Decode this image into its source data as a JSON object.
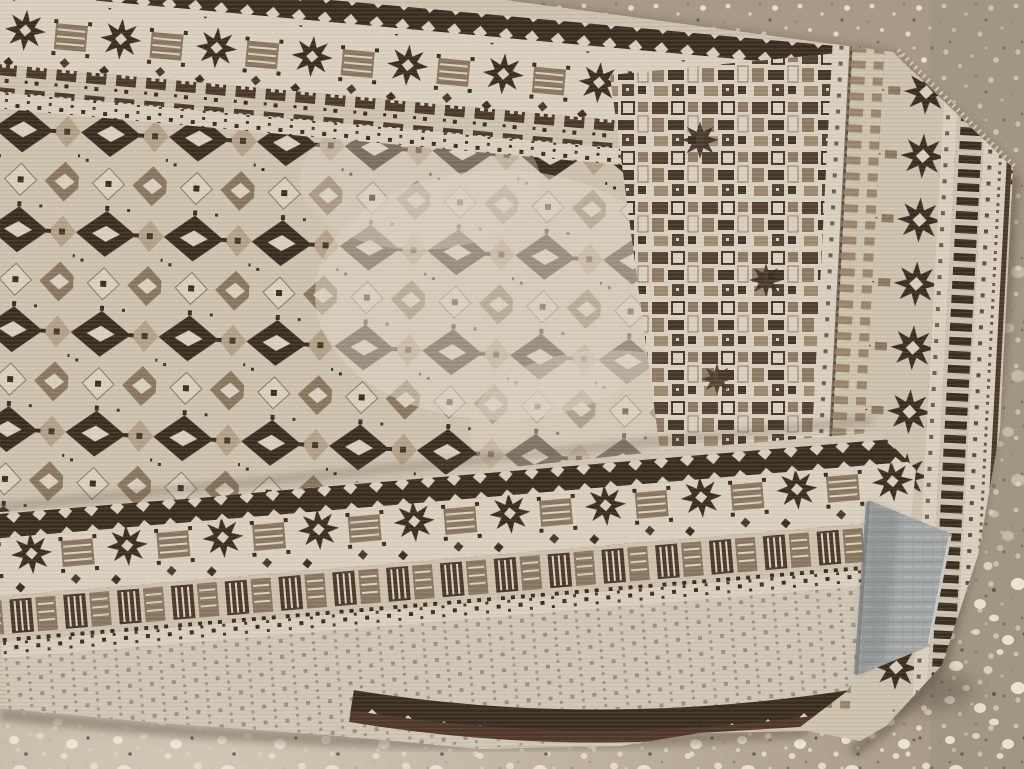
{
  "scene": {
    "title": "Vintage tribal runner rug on terrazzo floor",
    "description": "Photograph of a hand-woven cream and dark-brown tribal runner rug with a diamond-lattice field, eight-point-star borders and ladder stripes; one end of the runner is folded back over itself, its corner curling to show the gray woven underside, all lying on a speckled terrazzo concrete floor",
    "objects": {
      "rug": "cream and brown geometric tribal runner rug",
      "flap": "folded-over end of the runner with star and comb-block border bands",
      "underside": "gray-blue woven back of the curled rug corner",
      "floor": "tan terrazzo concrete floor with white pebble speckles"
    },
    "motifs": [
      "eight-point star",
      "diamond lattice",
      "ladder stripe",
      "comb block band",
      "diamond guard band",
      "dot guard stripe"
    ]
  },
  "colors": {
    "floor_base": "#a79b87",
    "floor_light": "#d6ccb9",
    "floor_olive": "#968c79",
    "floor_shadow": "#5e5244",
    "pebble_light": "#ece4d3",
    "rug_cream": "#ccc2ae",
    "rug_cream2": "#d9d0be",
    "rug_pale": "#cfc6b3",
    "dk": "#3b2f22",
    "dk2": "#4b3a2a",
    "md": "#8a775f",
    "md2": "#9b8769",
    "md3": "#b3a188",
    "selvedge": "#52392a",
    "back_gray": "#a3a8a6",
    "back_gray_dark": "#74787a",
    "back_gray_light": "#c6c9c6",
    "wear": "#dbd2c0",
    "fringe": "#dcd3c0"
  }
}
